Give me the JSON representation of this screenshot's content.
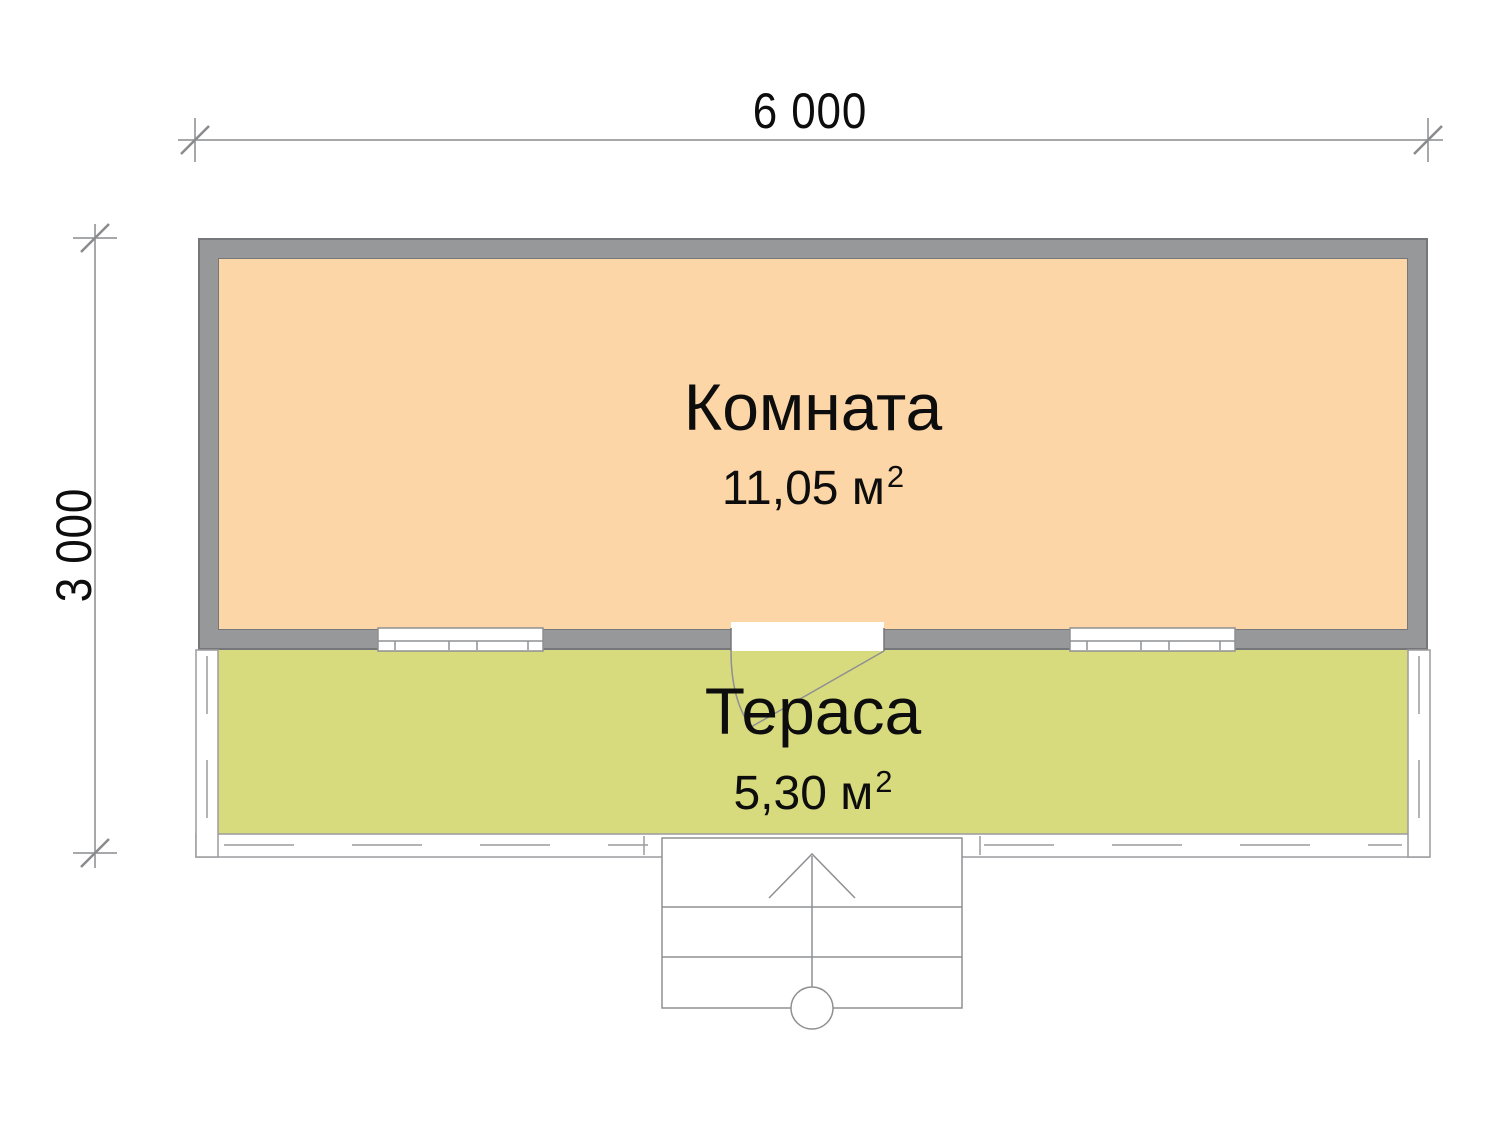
{
  "plan": {
    "title": "floor-plan",
    "dimensions": {
      "width": "6 000",
      "height": "3 000"
    },
    "rooms": [
      {
        "name": "Комната",
        "area": "11,05 м",
        "area_sup": "2"
      },
      {
        "name": "Тераса",
        "area": "5,30 м",
        "area_sup": "2"
      }
    ]
  },
  "colors": {
    "room_fill": "#fcd6a6",
    "terrace_fill": "#d8db7d",
    "wall": "#97989a",
    "wall_edge": "#76777a",
    "line": "#8f9092",
    "text": "#0d0d0d"
  }
}
